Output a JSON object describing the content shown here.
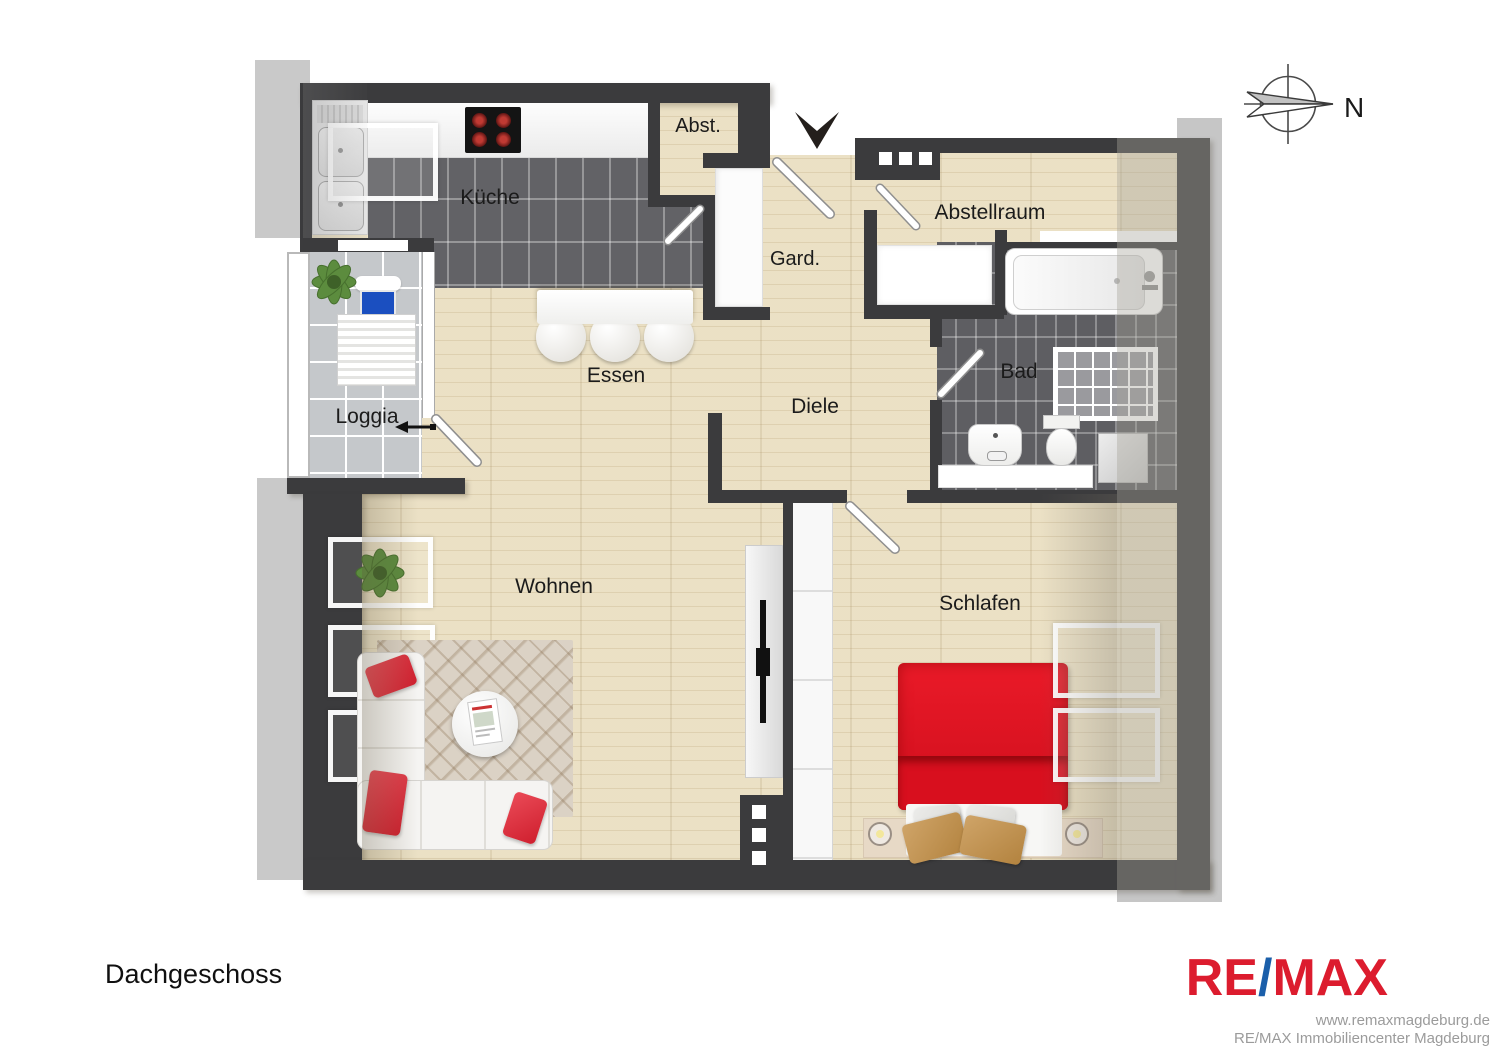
{
  "plan": {
    "title": "Dachgeschoss",
    "compass_label": "N",
    "rooms": {
      "kueche": "Küche",
      "abst": "Abst.",
      "gard": "Gard.",
      "abstellraum": "Abstellraum",
      "bad": "Bad",
      "essen": "Essen",
      "diele": "Diele",
      "loggia": "Loggia",
      "wohnen": "Wohnen",
      "schlafen": "Schlafen"
    },
    "colors": {
      "wall": "#3b3b3d",
      "wood_floor": "#eadfc2",
      "dark_tile": "#626266",
      "loggia_tile": "#c5c8cb",
      "roof_strip_gray": "#c9c9c9",
      "bed_red": "#d8101f",
      "lounger_pillow_blue": "#1b4fc0"
    }
  },
  "branding": {
    "logo": {
      "part1": "RE",
      "slash": "/",
      "part2": "MAX"
    },
    "logo_red": "#dc1c2e",
    "logo_blue": "#1b5faa",
    "website": "www.remaxmagdeburg.de",
    "office": "RE/MAX Immobiliencenter Magdeburg"
  }
}
